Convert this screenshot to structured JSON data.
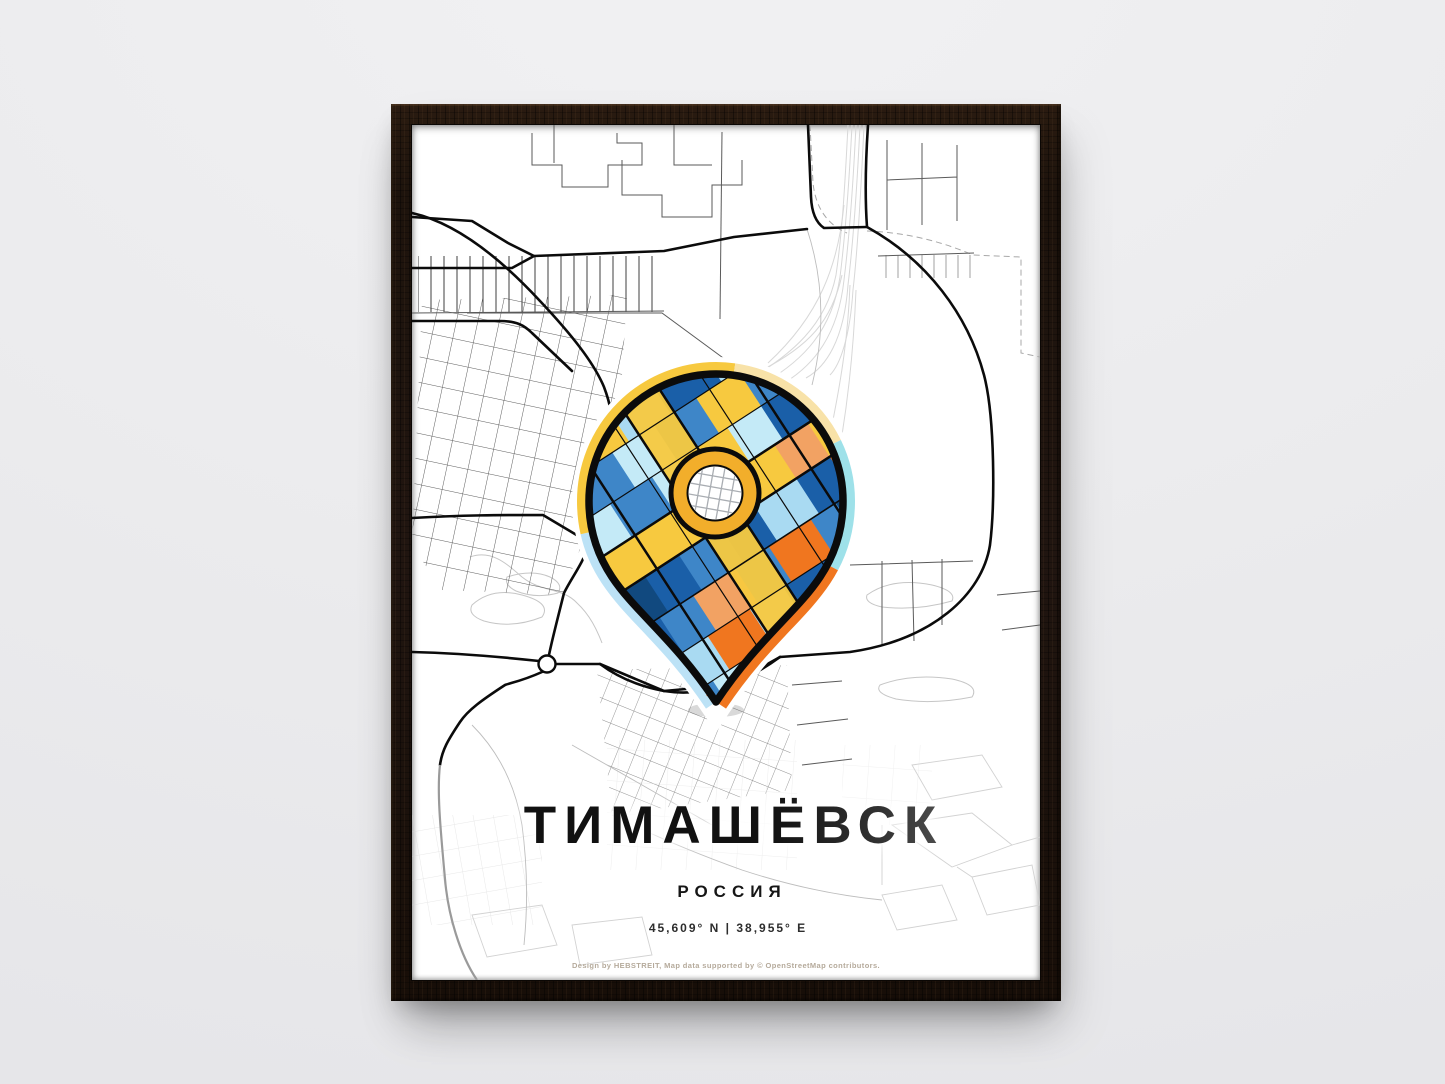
{
  "scene": {
    "wall_color": "#ECECEE",
    "frame_color": "#1D130C"
  },
  "poster": {
    "title": "ТИМАШЁВСК",
    "subtitle": "РОССИЯ",
    "coordinates": "45,609° N | 38,955° E",
    "credit": "Design by HEBSTREIT, Map data supported by © OpenStreetMap contributors."
  },
  "map": {
    "style": "monochrome street map with colorful mosaic location pin",
    "road_color": "#0B0B0B",
    "minor_road_color": "#4F4F4F",
    "faint_color": "#D6D6D6",
    "pin": {
      "icon": "map-pin-icon",
      "center_icon": "ring-target-icon",
      "palette": {
        "gold": "#F7C93F",
        "ring_gold": "#F2AE2B",
        "orange": "#F0761F",
        "peach": "#F2A263",
        "sky_blue": "#A9DAF2",
        "pale_cyan": "#C4EAF7",
        "medium_blue": "#3E86C8",
        "deep_blue": "#1A5FA8",
        "navy": "#11497F",
        "halo_cream": "#F8E2A8",
        "halo_cyan": "#9EE1E9",
        "halo_blue": "#BCE2F6"
      }
    }
  }
}
